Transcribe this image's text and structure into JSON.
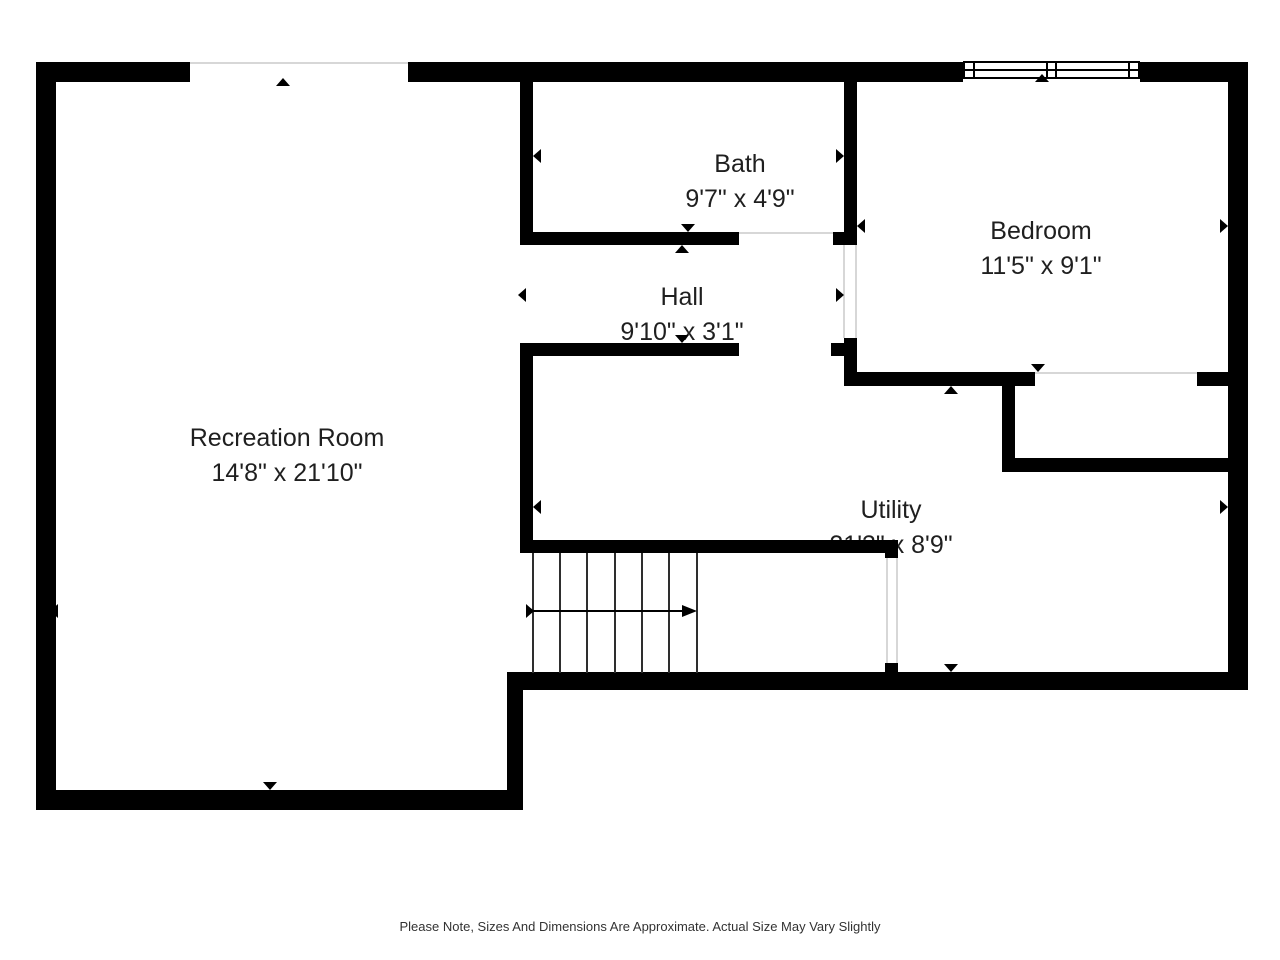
{
  "plan": {
    "type": "floor-plan",
    "rooms": [
      {
        "name": "Recreation Room",
        "dimensions": "14'8\" x 21'10\""
      },
      {
        "name": "Bath",
        "dimensions": "9'7\" x 4'9\""
      },
      {
        "name": "Hall",
        "dimensions": "9'10\" x 3'1\""
      },
      {
        "name": "Bedroom",
        "dimensions": "11'5\" x 9'1\""
      },
      {
        "name": "Utility",
        "dimensions": "21'3\" x 8'9\""
      }
    ],
    "features": [
      "window",
      "staircase",
      "door-openings"
    ],
    "colors": {
      "wall": "#000000",
      "background": "#ffffff",
      "door_frame": "#d7d7d7",
      "text": "#1f1f1f"
    }
  },
  "footer": {
    "note": "Please Note, Sizes And Dimensions Are Approximate. Actual Size May Vary Slightly"
  }
}
